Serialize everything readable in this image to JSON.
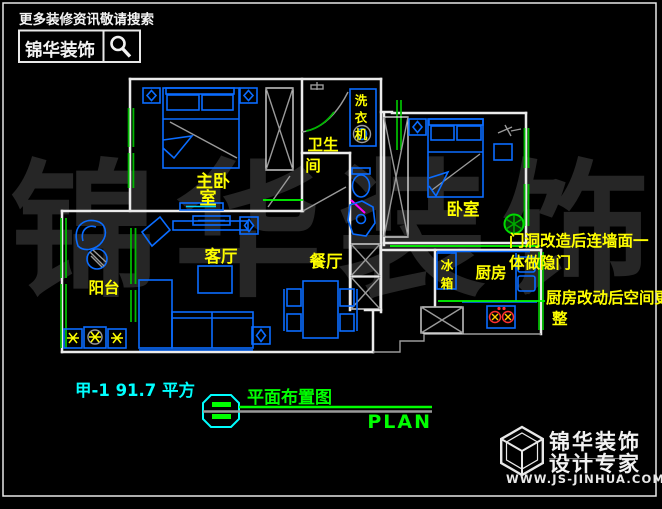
{
  "colors": {
    "background": "#000000",
    "wall": "#ebebeb",
    "furniture_blue": "#0a6cff",
    "window_green": "#00b800",
    "leader_green": "#00ff00",
    "label_yellow": "#ffff00",
    "annotation_cyan": "#00ffff",
    "magenta": "#ff00ff",
    "stove_red": "#ff3030",
    "watermark_gray": "#262626"
  },
  "header": {
    "promo": "更多装修资讯敬请搜索",
    "brand": "锦华装饰",
    "search_icon": "magnifier"
  },
  "watermark": {
    "text": "锦华装饰"
  },
  "plan": {
    "labels": {
      "master_l1": "主卧",
      "master_l2": "室",
      "bath_l1": "卫生",
      "bath_l2": "间",
      "laundry": [
        "洗",
        "衣",
        "机"
      ],
      "bedroom": "卧室",
      "living": "客厅",
      "dining": "餐厅",
      "balcony": "阳台",
      "kitchen": "厨房",
      "fridge": [
        "冰",
        "箱"
      ]
    },
    "notes": [
      {
        "line1": "门洞改造后连墙面一",
        "line2": "体做隐门"
      },
      {
        "line1": "厨房改动后空间更",
        "line2": "整"
      }
    ]
  },
  "footer": {
    "unit": "甲-1  91.7 平方",
    "title": "平面布置图",
    "title_en": "PLAN"
  },
  "logo": {
    "brand": "锦华装饰",
    "tagline": "设计专家",
    "url": "WWW.JS-JINHUA.COM"
  }
}
